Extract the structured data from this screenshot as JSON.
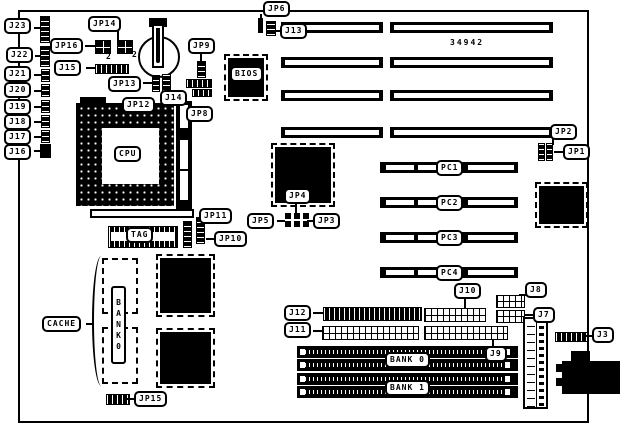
{
  "diagram": {
    "board_number": "34942",
    "connector_labels": {
      "j23": "J23",
      "j22": "J22",
      "j21": "J21",
      "j20": "J20",
      "j19": "J19",
      "j18": "J18",
      "j17": "J17",
      "j16": "J16",
      "j15": "J15",
      "j14": "J14",
      "j13": "J13",
      "j12": "J12",
      "j11": "J11",
      "j10": "J10",
      "j9": "J9",
      "j8": "J8",
      "j7": "J7",
      "j3": "J3"
    },
    "jumper_labels": {
      "jp1": "JP1",
      "jp2": "JP2",
      "jp3": "JP3",
      "jp4": "JP4",
      "jp5": "JP5",
      "jp6": "JP6",
      "jp8": "JP8",
      "jp9": "JP9",
      "jp10": "JP10",
      "jp11": "JP11",
      "jp12": "JP12",
      "jp13": "JP13",
      "jp14": "JP14",
      "jp15": "JP15",
      "jp16": "JP16"
    },
    "chip_labels": {
      "cpu": "CPU",
      "bios": "BIOS",
      "tag": "TAG",
      "cache": "CACHE"
    },
    "slot_labels": {
      "pc1": "PC1",
      "pc2": "PC2",
      "pc3": "PC3",
      "pc4": "PC4"
    },
    "memory_labels": {
      "bank0": "BANK 0",
      "bank1": "BANK 1",
      "cache_bank_vertical": "BANK0"
    },
    "pin_markers": {
      "jp16_pin2": "2",
      "jp14_pin2": "2"
    }
  }
}
